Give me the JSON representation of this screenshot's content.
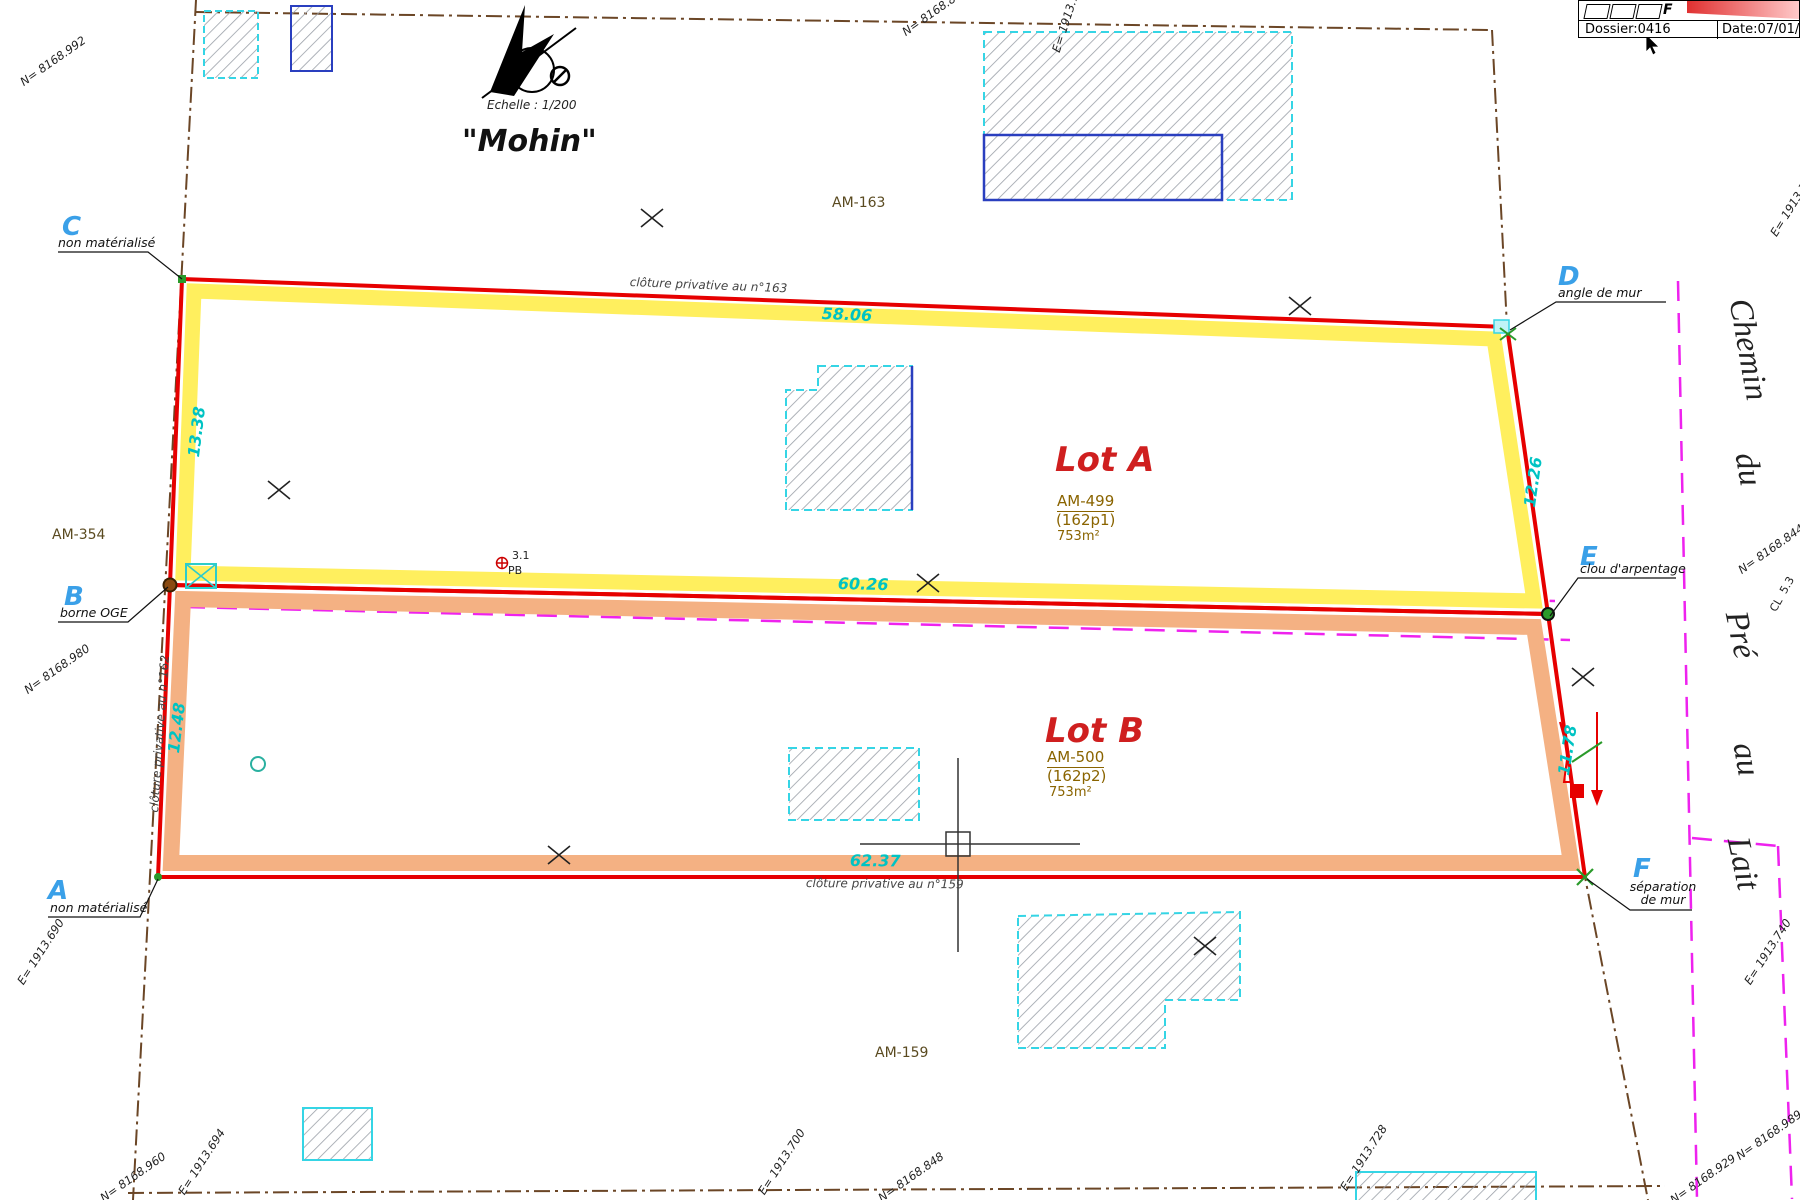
{
  "header": {
    "dossier": "Dossier:0416",
    "date": "Date:07/01/2",
    "logo_letter": "F"
  },
  "compass": {
    "scale_label": "Echelle : 1/200",
    "place_name": "\"Mohin\""
  },
  "lots": [
    {
      "name": "Lot A",
      "parcel": "AM-499",
      "index": "(162p1)",
      "area": "753m²"
    },
    {
      "name": "Lot B",
      "parcel": "AM-500",
      "index": "(162p2)",
      "area": "753m²"
    }
  ],
  "parcels": {
    "am163": "AM-163",
    "am354": "AM-354",
    "am159": "AM-159"
  },
  "points": [
    {
      "id": "C",
      "desc": "non matérialisé"
    },
    {
      "id": "D",
      "desc": "angle de mur"
    },
    {
      "id": "B",
      "desc": "borne OGE"
    },
    {
      "id": "E",
      "desc": "clou d'arpentage"
    },
    {
      "id": "A",
      "desc": "non matérialisé"
    },
    {
      "id": "F",
      "desc": "séparation de mur"
    }
  ],
  "measurements": {
    "top": "58.06",
    "middle": "60.26",
    "bottom": "62.37",
    "left_lot_a": "13.38",
    "left_lot_b": "12.48",
    "right_lot_a": "12.26",
    "right_lot_b": "11.78"
  },
  "fences": {
    "n163": "clôture privative au n°163",
    "n162": "clôture privative au n°162",
    "n159": "clôture privative au n°159"
  },
  "street": {
    "w1": "Chemin",
    "w2": "du",
    "w3": "Pré",
    "w4": "au",
    "w5": "Lait"
  },
  "coords": {
    "top_left": "N= 8168.992",
    "top_middle": "N= 8168.84",
    "top_middle_steep": "E= 1913.744",
    "top_right": "E= 1913.760",
    "right_middle": "N= 8168.844",
    "right_lower": "E= 1913.740",
    "left_below_b": "N= 8168.980",
    "left_lower": "E= 1913.690",
    "bottom_left_n": "N= 8168.960",
    "bottom_left_e": "E= 1913.694",
    "bottom_middle_e": "E= 1913.700",
    "bottom_middle_n": "N= 8168.848",
    "bottom_right_e": "E= 1913.728",
    "bottom_right_n": "N= 8168.929",
    "far_right_n": "N= 8168.989"
  },
  "survey_notes": {
    "pb_value": "3.1",
    "pb_label": "PB",
    "cl_value": "5.3",
    "cl_label": "CL"
  },
  "colors": {
    "boundary_red": "#e60000",
    "highlight_a": "#ffef5e",
    "highlight_b": "#f4b183",
    "magenta_dashed": "#ee22ee",
    "old_boundary_brown": "#6b4626",
    "building_cyan": "#35d5e5",
    "building_blue": "#2a3fbf",
    "measure_cyan": "#00c3c3",
    "point_blue": "#3aa0e8",
    "lot_red": "#cf1f1f"
  }
}
